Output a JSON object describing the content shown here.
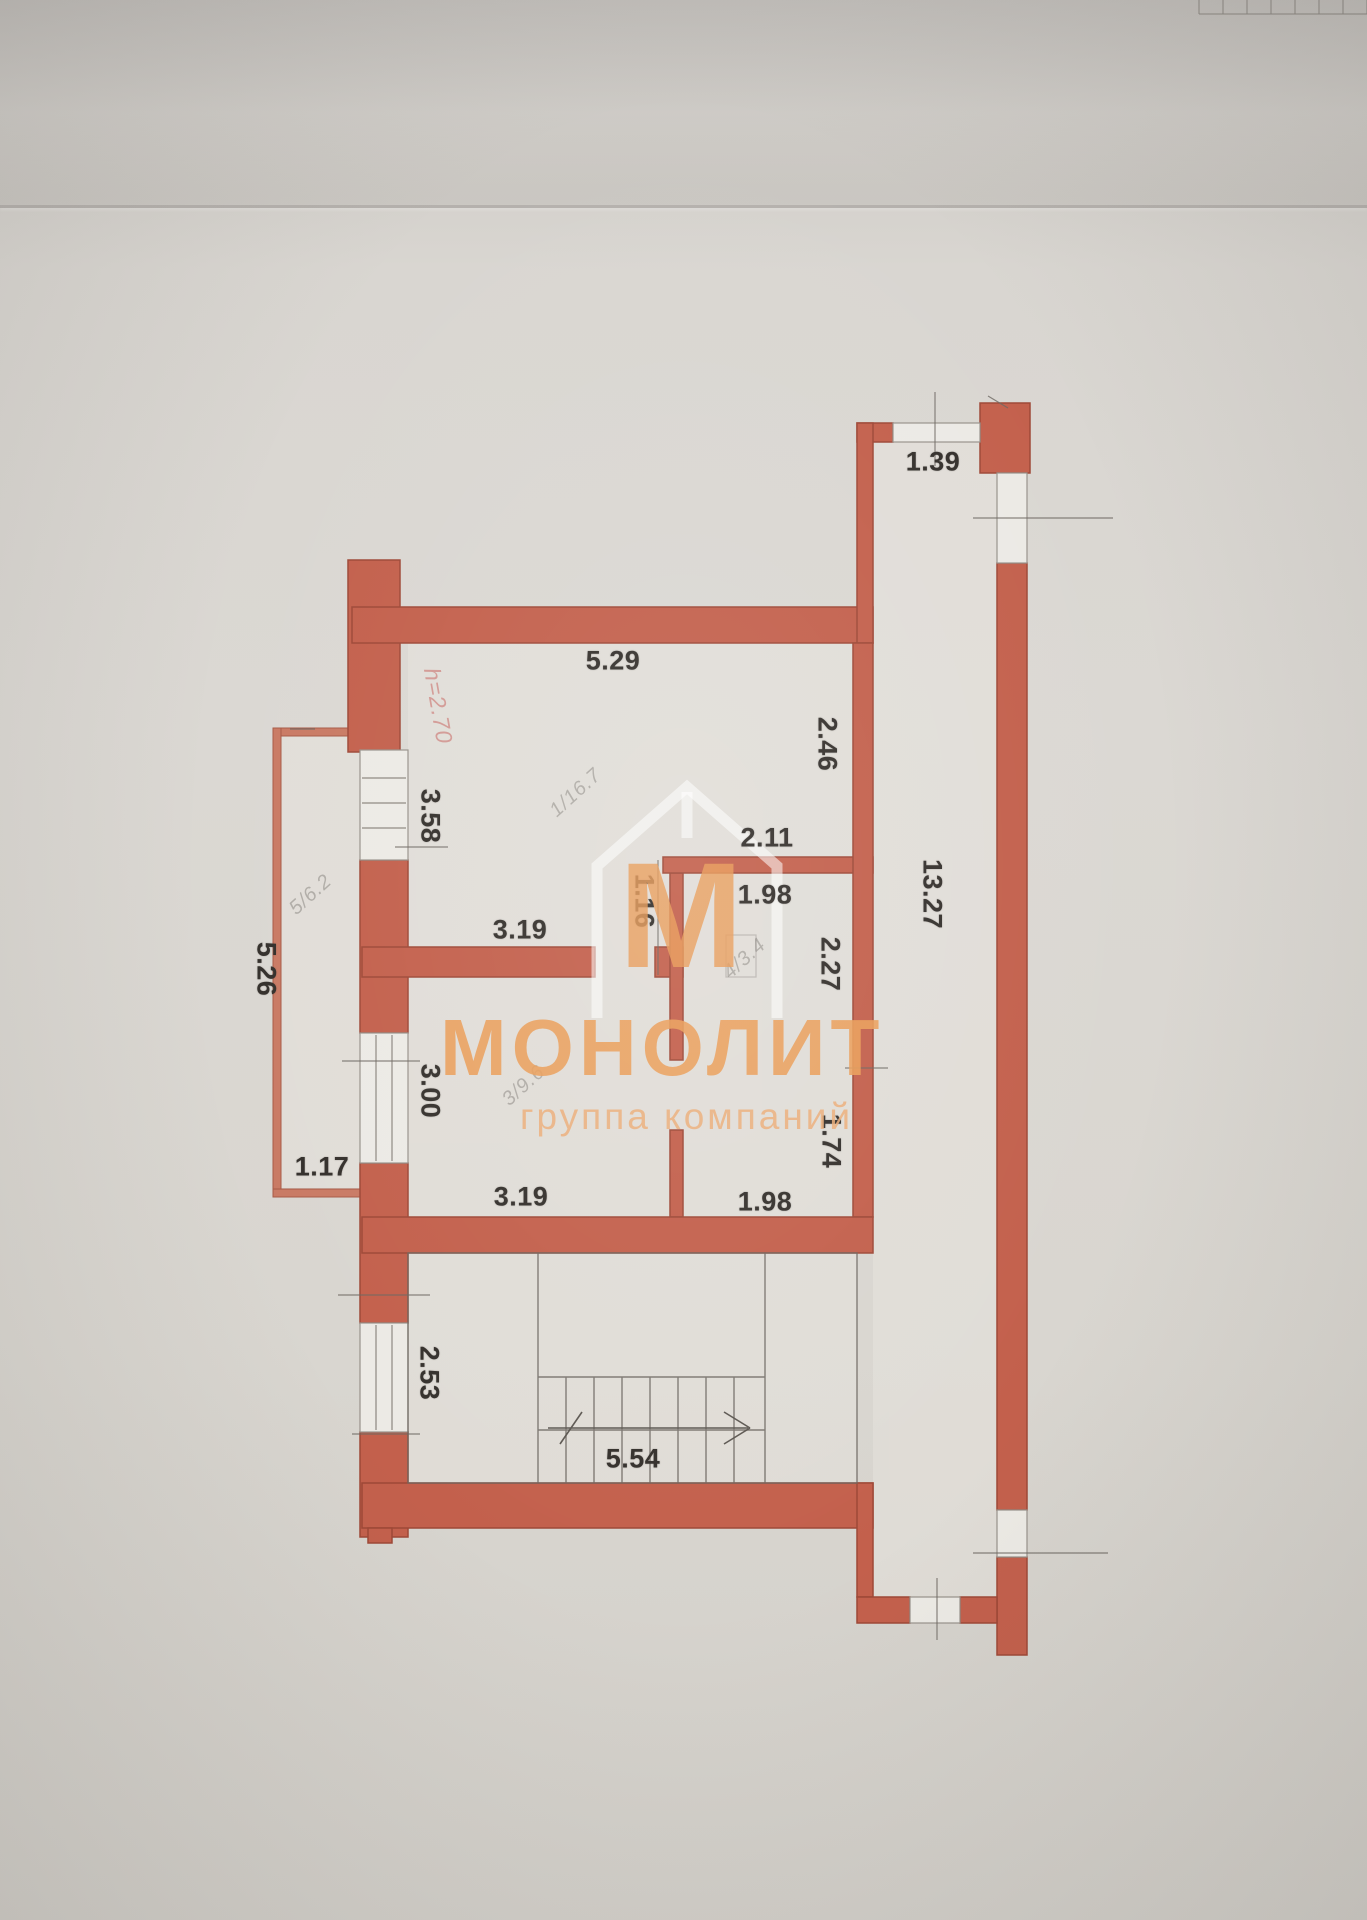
{
  "watermark": {
    "logo_letter": "М",
    "brand": "МОНОЛИТ",
    "tagline": "группа компаний",
    "brand_color": "#e89a55"
  },
  "plan": {
    "wall_color": "#c3604c",
    "height_note": {
      "text": "h=2.70",
      "x": 438,
      "y": 706,
      "rot": 80
    },
    "dimensions": [
      {
        "text": "1.39",
        "x": 933,
        "y": 462,
        "rot": 0
      },
      {
        "text": "5.29",
        "x": 613,
        "y": 661,
        "rot": 0
      },
      {
        "text": "2.46",
        "x": 827,
        "y": 744,
        "rot": 90
      },
      {
        "text": "3.58",
        "x": 430,
        "y": 816,
        "rot": 90
      },
      {
        "text": "2.11",
        "x": 767,
        "y": 838,
        "rot": 0
      },
      {
        "text": "1.98",
        "x": 765,
        "y": 895,
        "rot": 0
      },
      {
        "text": "1.16",
        "x": 644,
        "y": 901,
        "rot": 90
      },
      {
        "text": "2.27",
        "x": 830,
        "y": 964,
        "rot": 90
      },
      {
        "text": "13.27",
        "x": 932,
        "y": 894,
        "rot": 90
      },
      {
        "text": "5.26",
        "x": 266,
        "y": 969,
        "rot": 90
      },
      {
        "text": "3.19",
        "x": 520,
        "y": 930,
        "rot": 0
      },
      {
        "text": "3.00",
        "x": 430,
        "y": 1091,
        "rot": 90
      },
      {
        "text": "1.74",
        "x": 831,
        "y": 1141,
        "rot": 90
      },
      {
        "text": "1.98",
        "x": 765,
        "y": 1202,
        "rot": 0
      },
      {
        "text": "1.17",
        "x": 322,
        "y": 1167,
        "rot": 0
      },
      {
        "text": "3.19",
        "x": 521,
        "y": 1197,
        "rot": 0
      },
      {
        "text": "2.53",
        "x": 429,
        "y": 1373,
        "rot": 90
      },
      {
        "text": "5.54",
        "x": 633,
        "y": 1459,
        "rot": 0
      }
    ],
    "room_labels": [
      {
        "text": "1/16.7",
        "x": 576,
        "y": 793,
        "rot": -42
      },
      {
        "text": "5/6.2",
        "x": 311,
        "y": 895,
        "rot": -42
      },
      {
        "text": "3/9.6",
        "x": 524,
        "y": 1086,
        "rot": -42
      },
      {
        "text": "4/3.4",
        "x": 745,
        "y": 959,
        "rot": -42
      }
    ]
  }
}
